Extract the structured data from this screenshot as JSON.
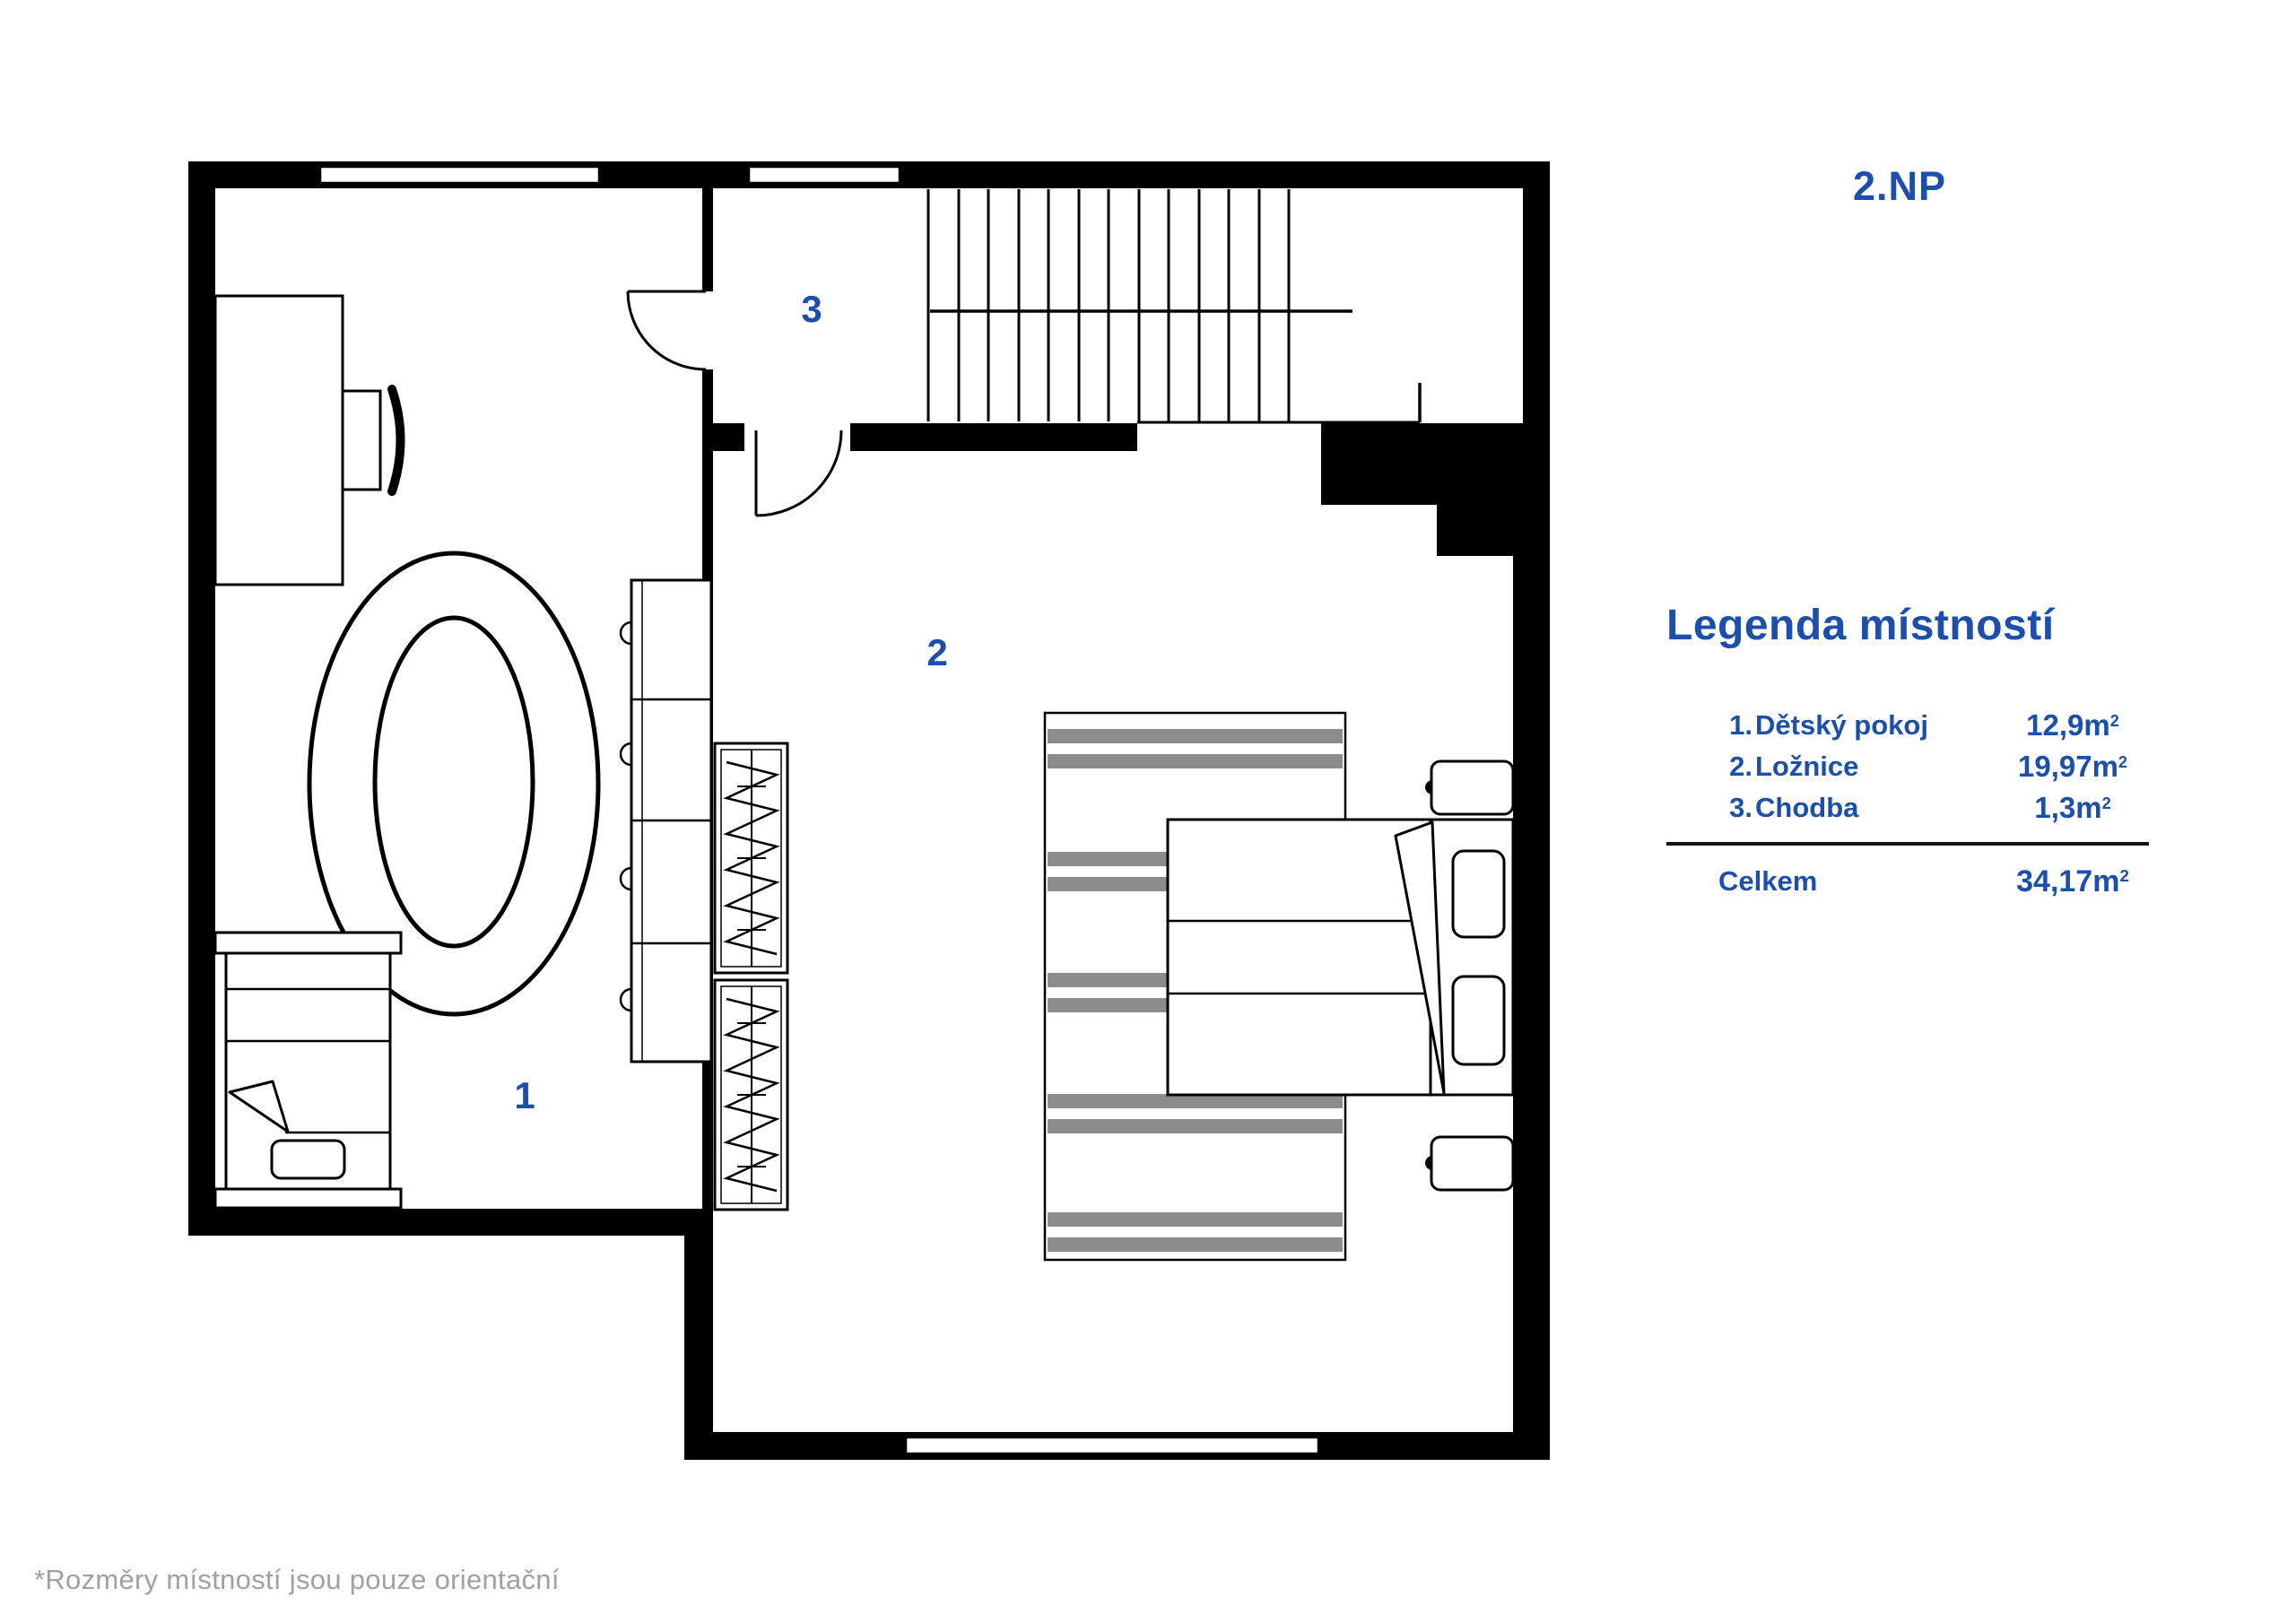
{
  "floor_label": "2.NP",
  "legend": {
    "title": "Legenda místností",
    "items": [
      {
        "num": "1.",
        "name": "Dětský pokoj",
        "area": "12,9m",
        "sup": "2"
      },
      {
        "num": "2.",
        "name": "Ložnice",
        "area": "19,97m",
        "sup": "2"
      },
      {
        "num": "3.",
        "name": "Chodba",
        "area": "1,3m",
        "sup": "2"
      }
    ],
    "total": {
      "label": "Celkem",
      "area": "34,17m",
      "sup": "2"
    }
  },
  "plan": {
    "room_labels": [
      "1",
      "2",
      "3"
    ]
  },
  "footnote": "*Rozměry místností jsou pouze orientační",
  "colors": {
    "accent": "#1b4fae",
    "wall": "#000000",
    "stripe": "#8c8c8c",
    "footnote": "#9ba2a9"
  }
}
